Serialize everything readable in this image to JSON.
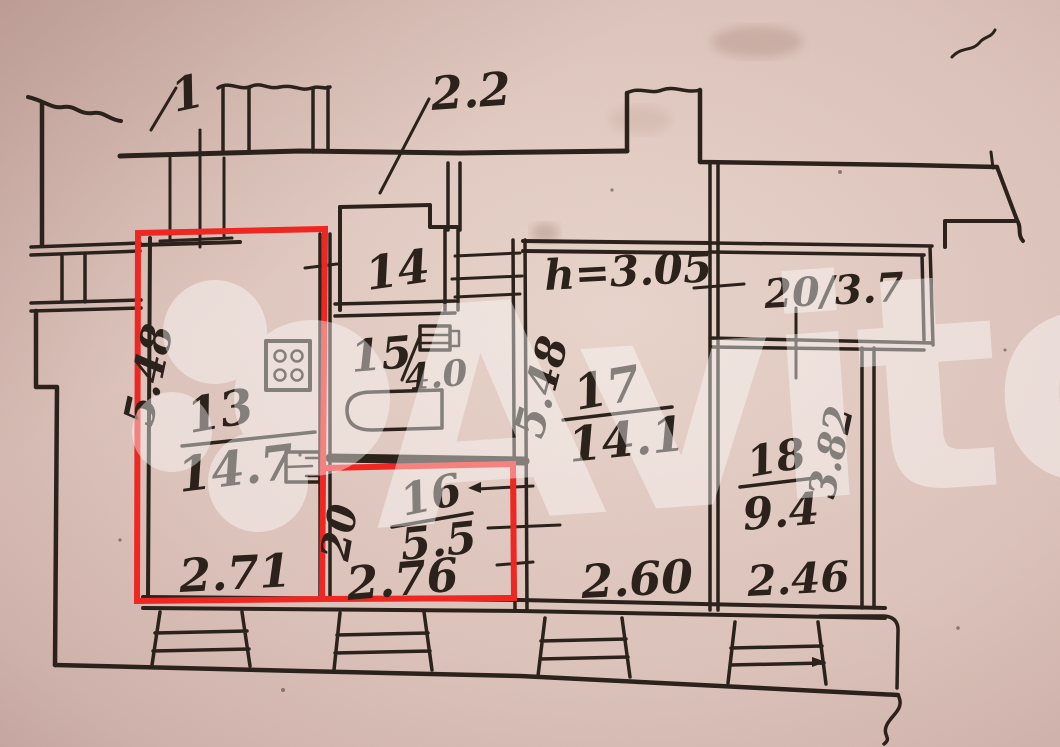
{
  "annotations": {
    "mark_1": "1",
    "wall_thickness": "2.2",
    "ceiling_height": "h=3.05"
  },
  "rooms": {
    "r13": {
      "number": "13",
      "area": "14.7",
      "width": "2.71",
      "depth": "5.48"
    },
    "r14": {
      "number": "14"
    },
    "r15": {
      "number": "15",
      "area": "4.0"
    },
    "r16": {
      "number": "16",
      "area": "5.5",
      "width": "2.76",
      "depth": "20"
    },
    "r17": {
      "number": "17",
      "area": "14.1",
      "width": "2.60",
      "depth": "5.48"
    },
    "r18": {
      "number": "18",
      "area": "9.4",
      "width": "2.46",
      "depth": "3.82"
    },
    "balcony": {
      "label": "20/3.7"
    }
  },
  "watermark": {
    "text": "Avito"
  },
  "colors": {
    "highlight": "#ee2722",
    "ink": "#2b221c",
    "paper": "#dcc3bc"
  }
}
